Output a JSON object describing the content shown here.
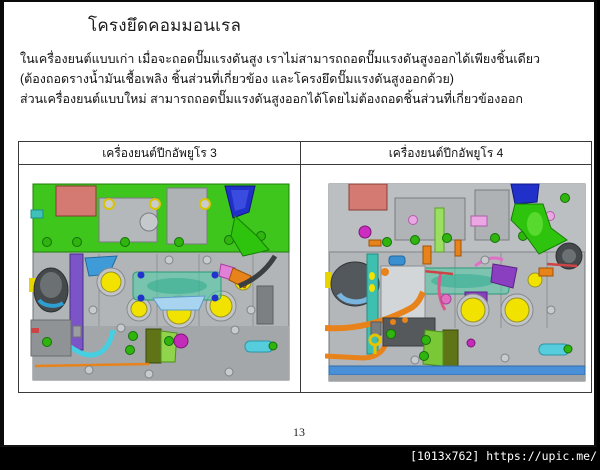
{
  "slide": {
    "title": "โครงยึดคอมมอนเรล",
    "body_lines": [
      "ในเครื่องยนต์แบบเก่า เมื่อจะถอดปั๊มแรงดันสูง เราไม่สามารถถอดปั๊มแรงดันสูงออกได้เพียงชิ้นเดียว",
      "(ต้องถอดรางน้ำมันเชื้อเพลิง ชิ้นส่วนที่เกี่ยวข้อง และโครงยึดปั๊มแรงดันสูงออกด้วย)",
      "ส่วนเครื่องยนต์แบบใหม่ สามารถถอดปั๊มแรงดันสูงออกได้โดยไม่ต้องถอดชิ้นส่วนที่เกี่ยวข้องออก"
    ],
    "page_number": "13"
  },
  "comparison_table": {
    "columns": [
      {
        "header": "เครื่องยนต์ปีกอัพยูโร 3"
      },
      {
        "header": "เครื่องยนต์ปีกอัพยูโร 4"
      }
    ]
  },
  "watermark": {
    "text": "[1013x762] https://upic.me/"
  },
  "colors": {
    "page_background": "#ffffff",
    "outer_background": "#000000",
    "engine_block_gray": "#b4b7b9",
    "head_green": "#3fc61c",
    "valve_cover_salmon": "#d47a72",
    "funnel_blue": "#2030c8",
    "port_yellow": "#f2e200",
    "rail_teal": "#48d0a8",
    "bracket_purple": "#7b55c8",
    "pipe_cyan": "#45cfe0",
    "harness_orange": "#e8821a",
    "bracket_olive": "#5f7317",
    "bolt_green": "#2fb50d",
    "accent_magenta": "#c22cb8",
    "strip_blue": "#4a90d9"
  }
}
